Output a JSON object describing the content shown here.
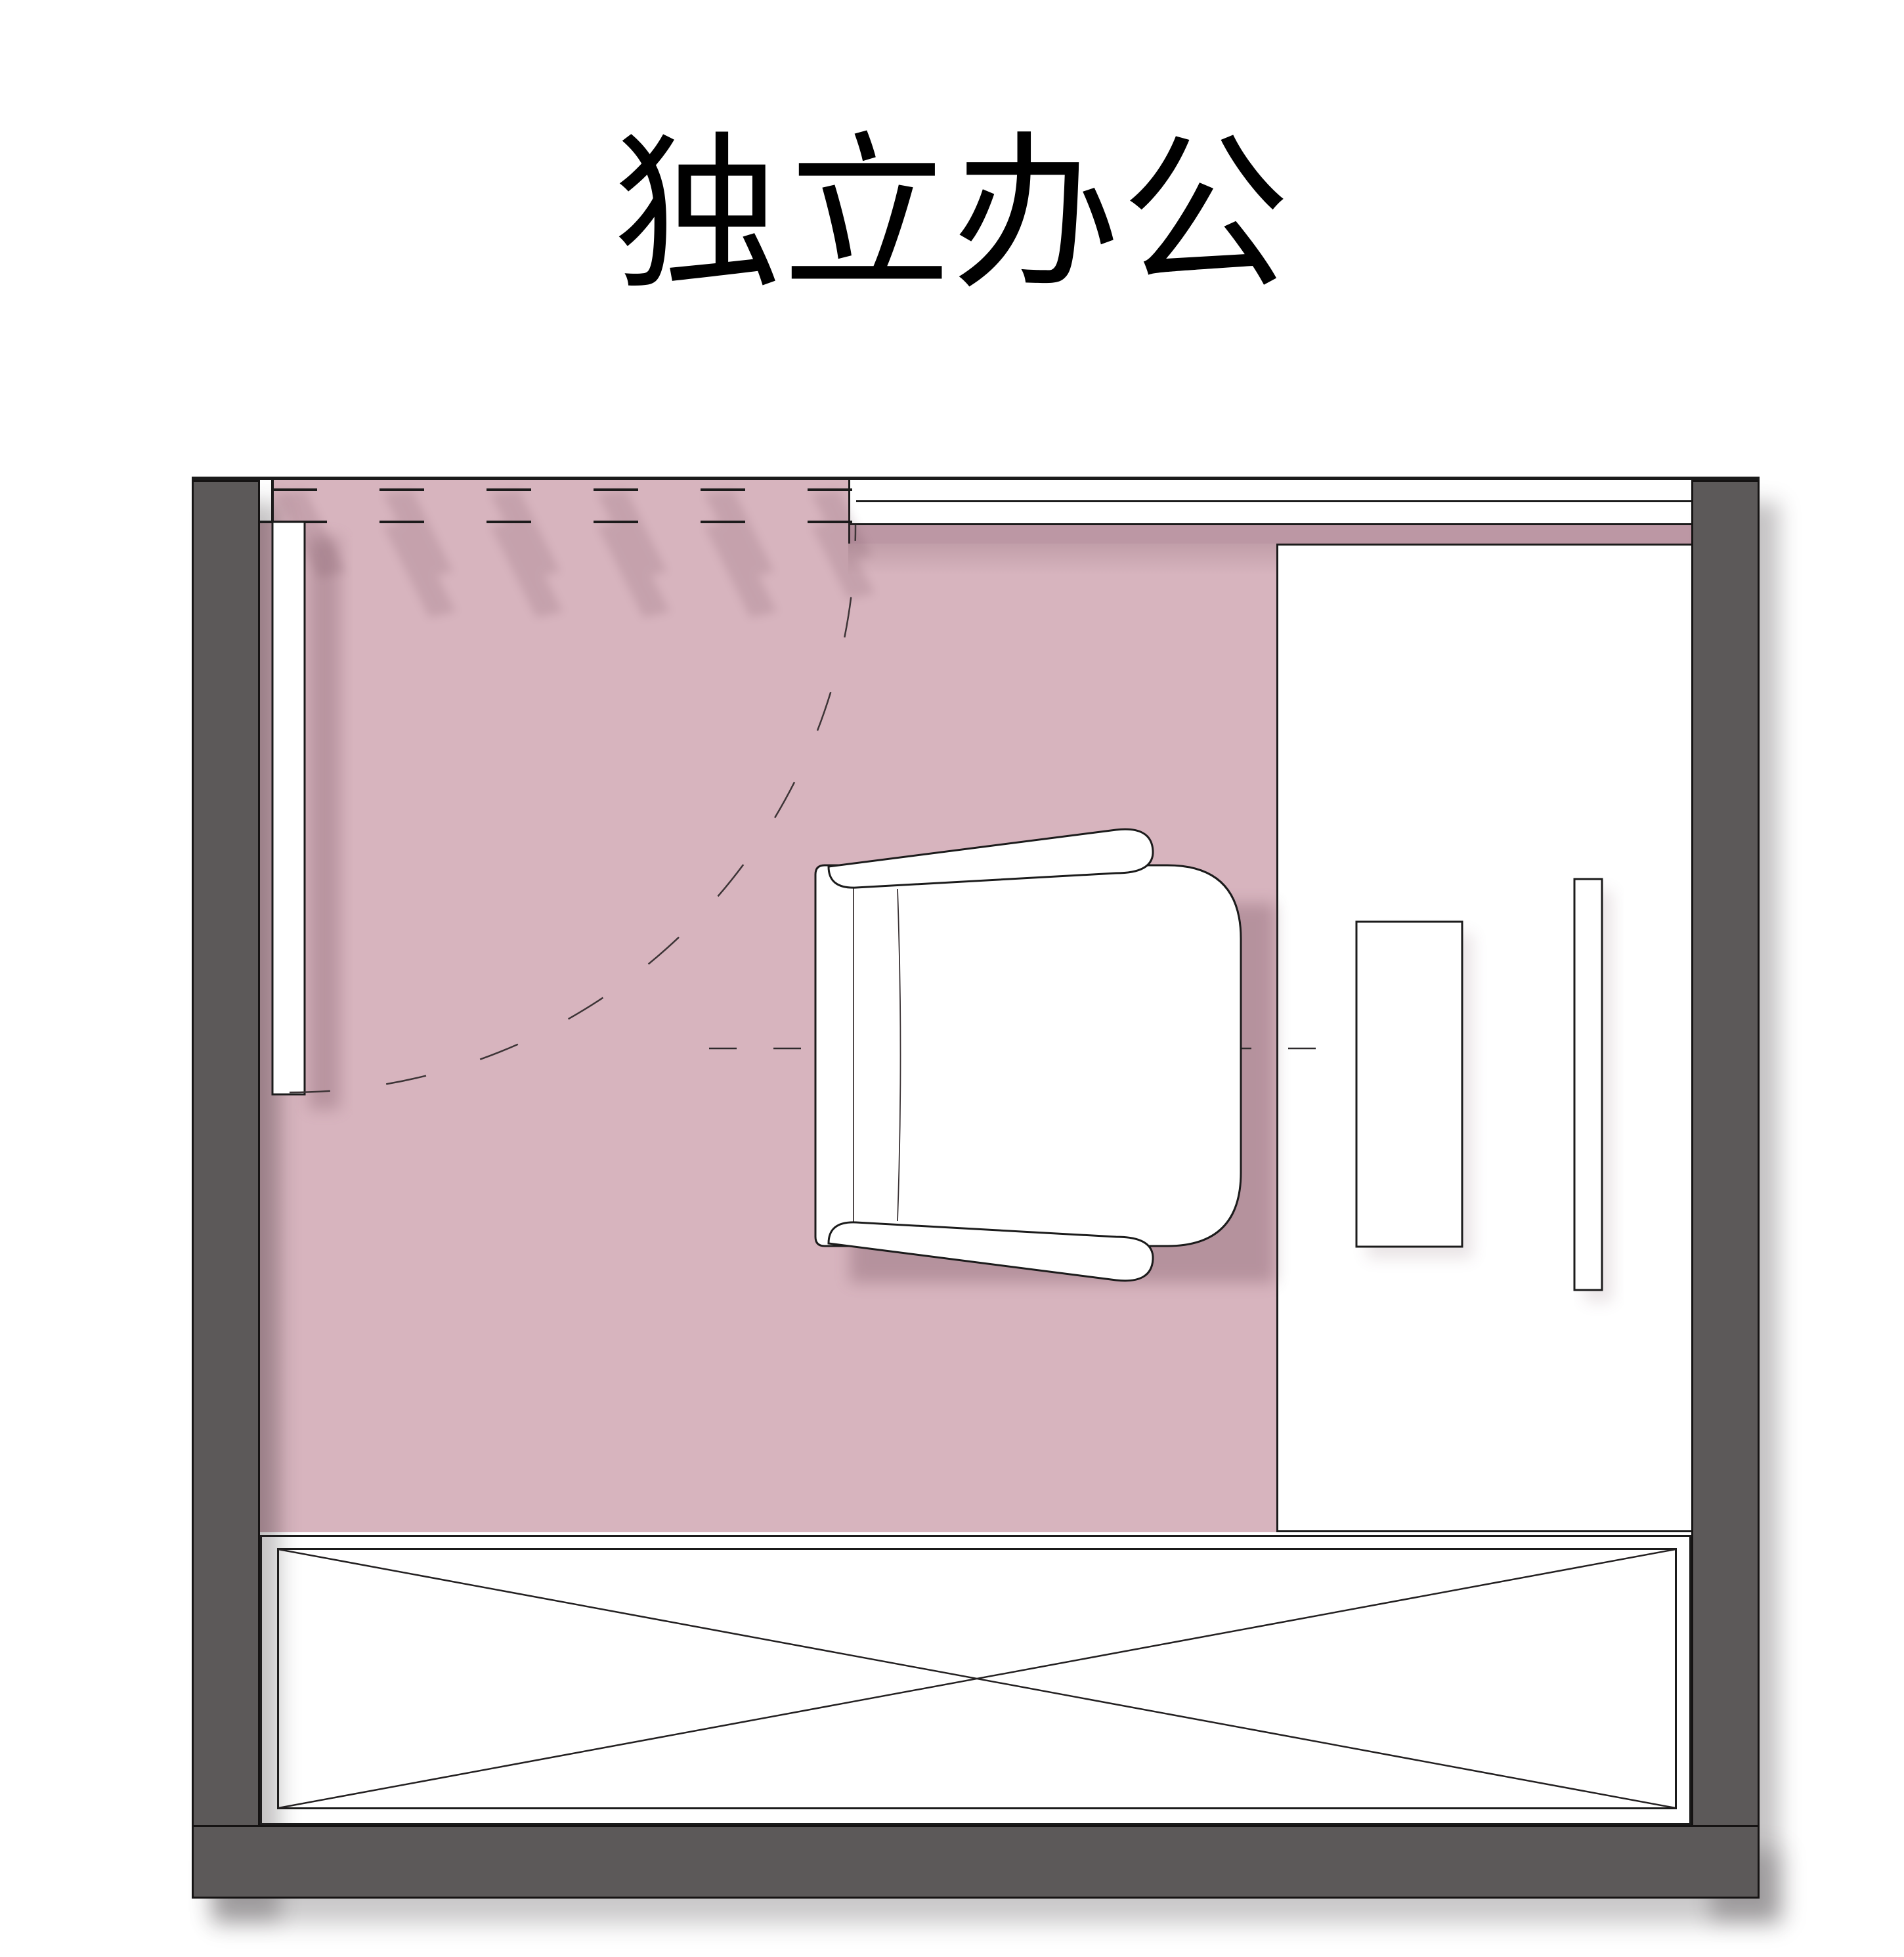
{
  "title": "独立办公",
  "palette": {
    "ink": "#000000",
    "line": "#1b1b1b",
    "wall": "#5c5959",
    "floor": "#d7b4be",
    "sill": "#bc97a4",
    "surface": "#ffffff",
    "soft_shadow": "#6b4452"
  },
  "plan": {
    "room_label": "独立办公",
    "elements": [
      "swing-door",
      "door-swing-arc",
      "window-band",
      "window-sill-band",
      "lounge-chair",
      "desk-worktop",
      "monitor",
      "shelf-strip",
      "storage-cabinet-x"
    ]
  }
}
